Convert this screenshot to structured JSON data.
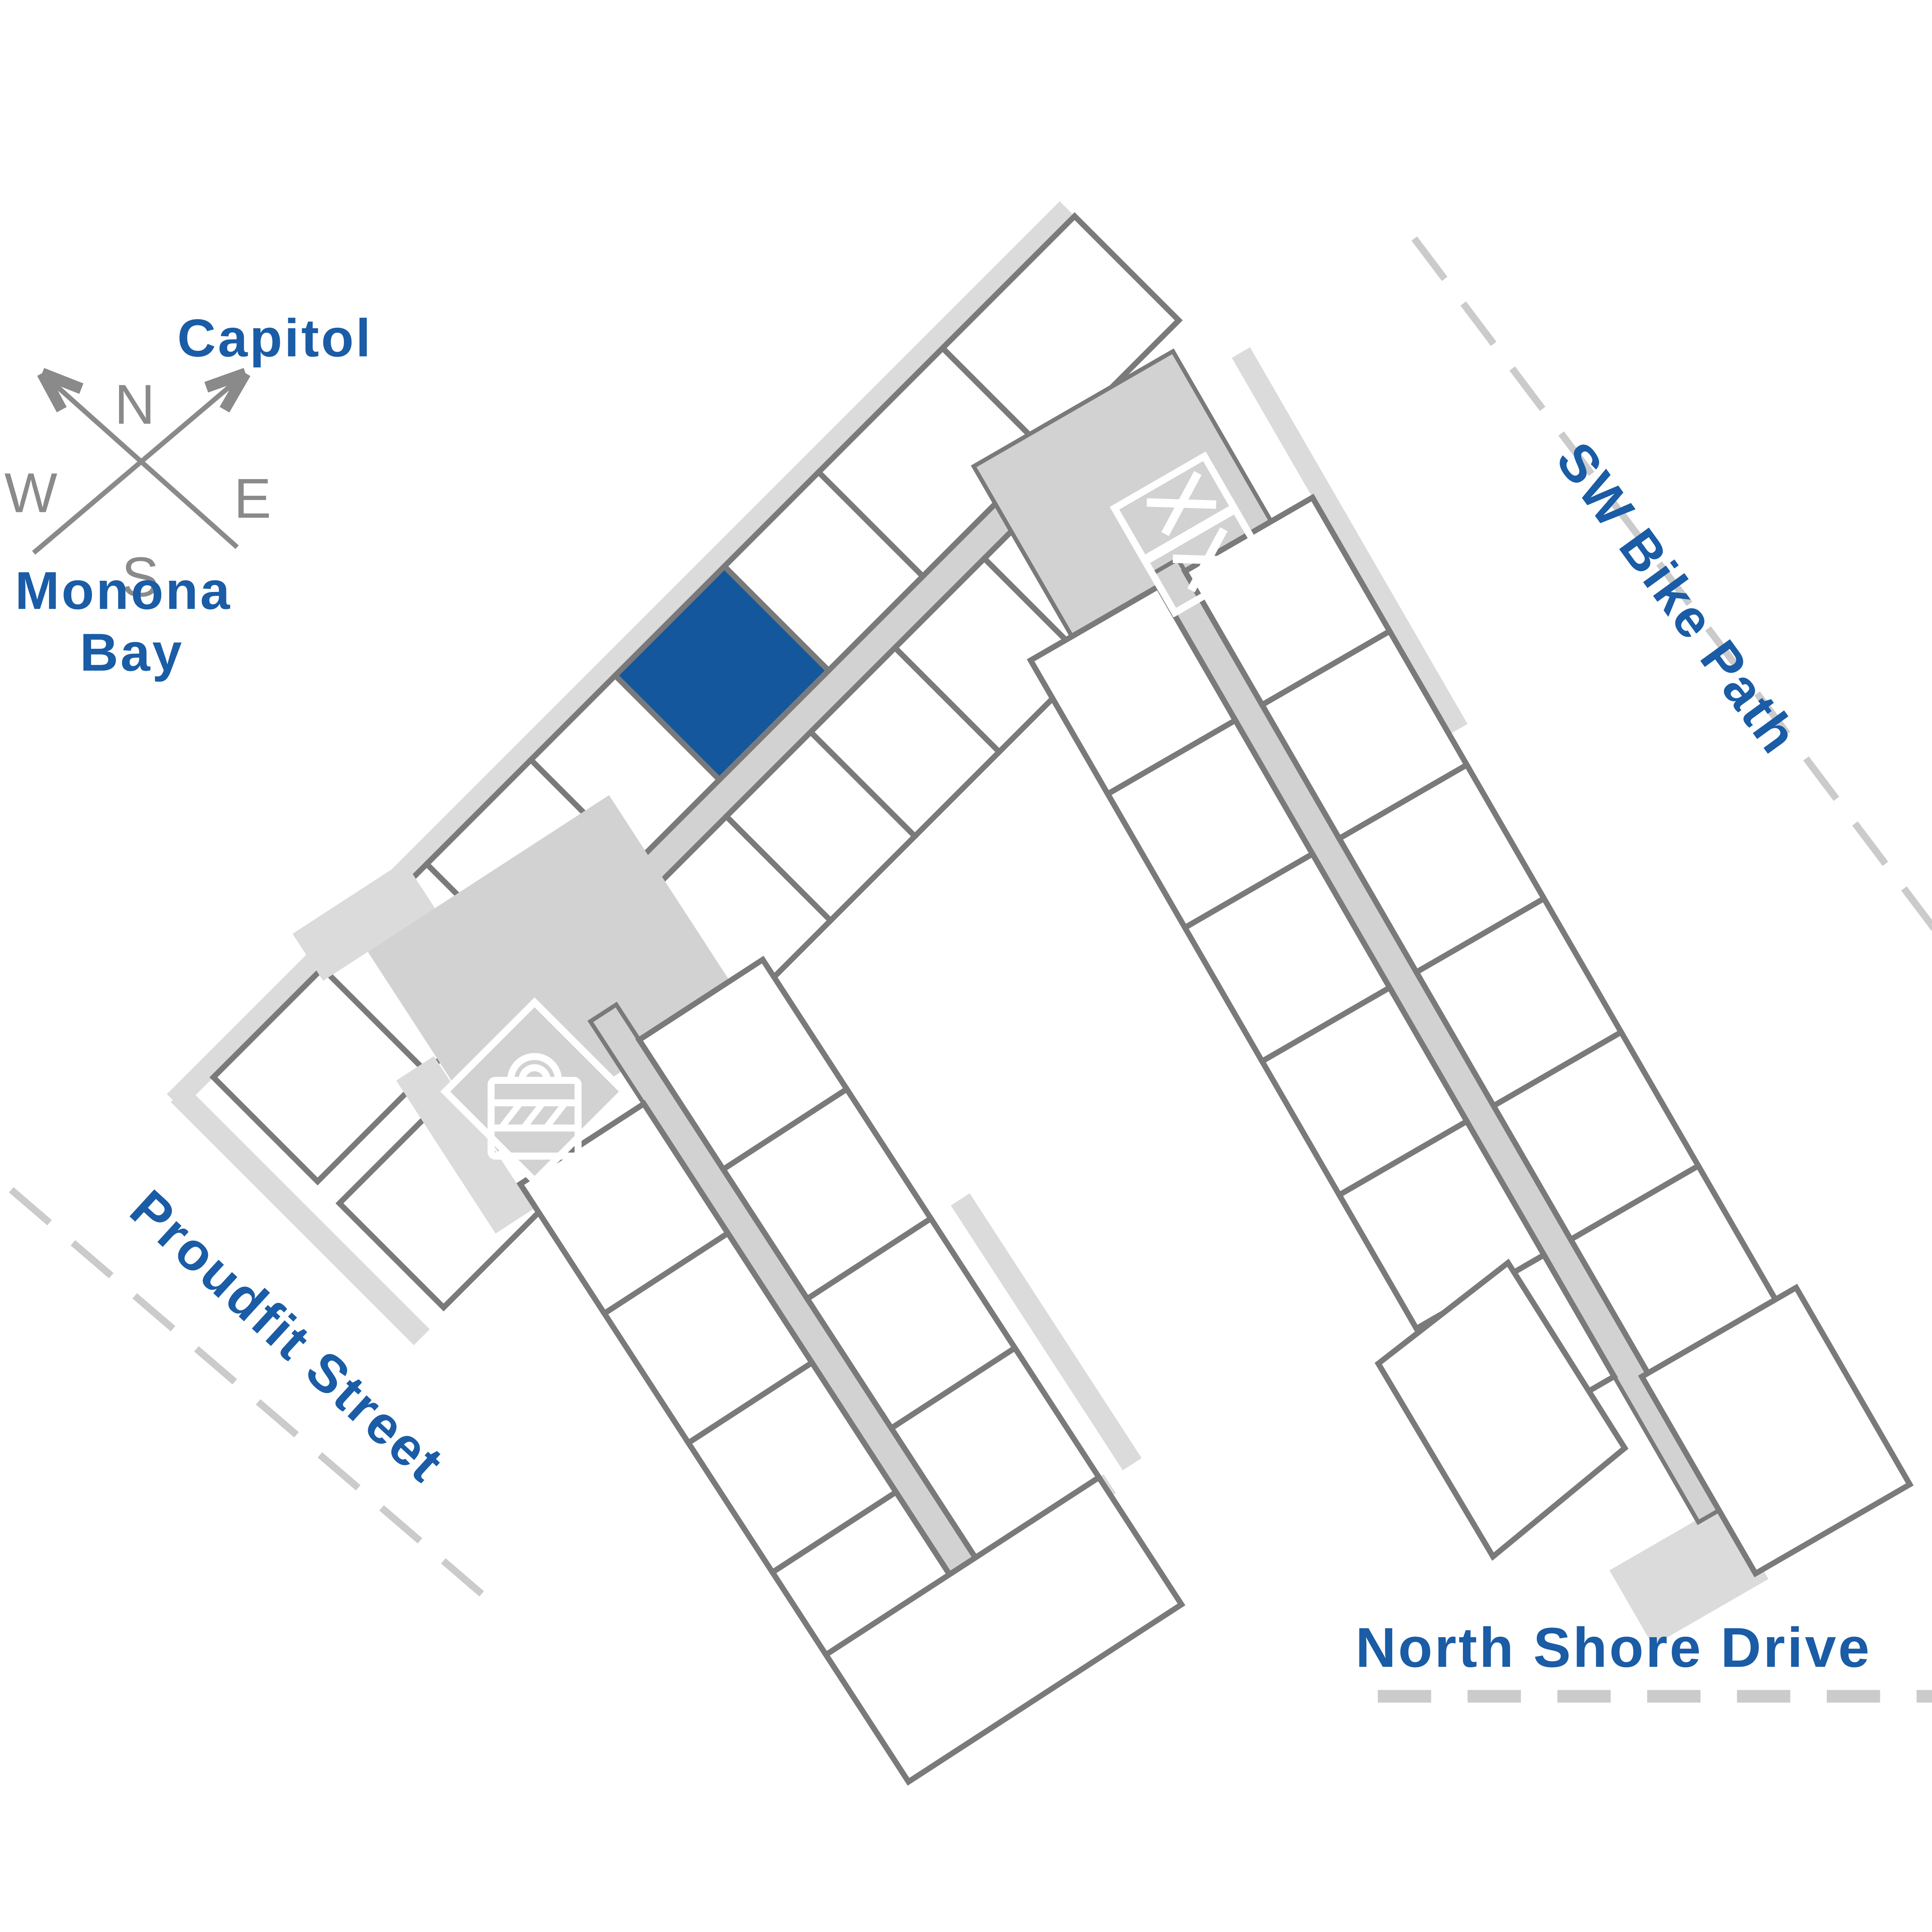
{
  "colors": {
    "accent_blue": "#14579D",
    "label_blue": "#1A5CA6",
    "outline_gray": "#7A7A7A",
    "floor_gray": "#D2D2D2",
    "shadow_gray": "#DBDBDB",
    "road_gray": "#CBCBCB",
    "compass_gray": "#8A8A8A"
  },
  "compass": {
    "north": "N",
    "west": "W",
    "east": "E",
    "south": "S"
  },
  "labels": {
    "capitol": "Capitol",
    "monona_bay": [
      "Monona",
      "Bay"
    ],
    "sw_bike_path": "SW Bike Path",
    "proudfit_street": "Proudfit Street",
    "north_shore_drive": "North Shore Drive"
  },
  "icons": {
    "compass": "crossed-arrows",
    "elevator": "double-box-with-x",
    "secured_storage": "padlock-with-hatch"
  },
  "highlighted_unit": {
    "selected": true,
    "fill": "#14579D"
  }
}
